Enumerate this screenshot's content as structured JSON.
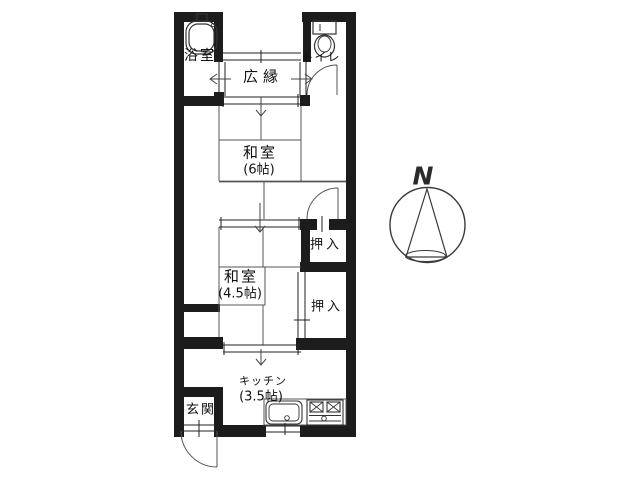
{
  "floorplan": {
    "colors": {
      "wall": "#1c1c1c",
      "line": "#4a4a4a",
      "background": "#ffffff"
    },
    "compass": {
      "label": "N"
    },
    "rooms": [
      {
        "id": "bathroom",
        "label": "浴室"
      },
      {
        "id": "veranda",
        "label": "広縁"
      },
      {
        "id": "toilet",
        "label": "トイレ"
      },
      {
        "id": "japanese-room-6",
        "label": "和室",
        "size": "(6帖)"
      },
      {
        "id": "closet-upper",
        "label": "押入"
      },
      {
        "id": "japanese-room-4-5",
        "label": "和室",
        "size": "(4.5帖)"
      },
      {
        "id": "closet-lower",
        "label": "押入"
      },
      {
        "id": "kitchen",
        "label": "キッチン",
        "size": "(3.5帖)"
      },
      {
        "id": "entrance",
        "label": "玄関"
      }
    ]
  }
}
